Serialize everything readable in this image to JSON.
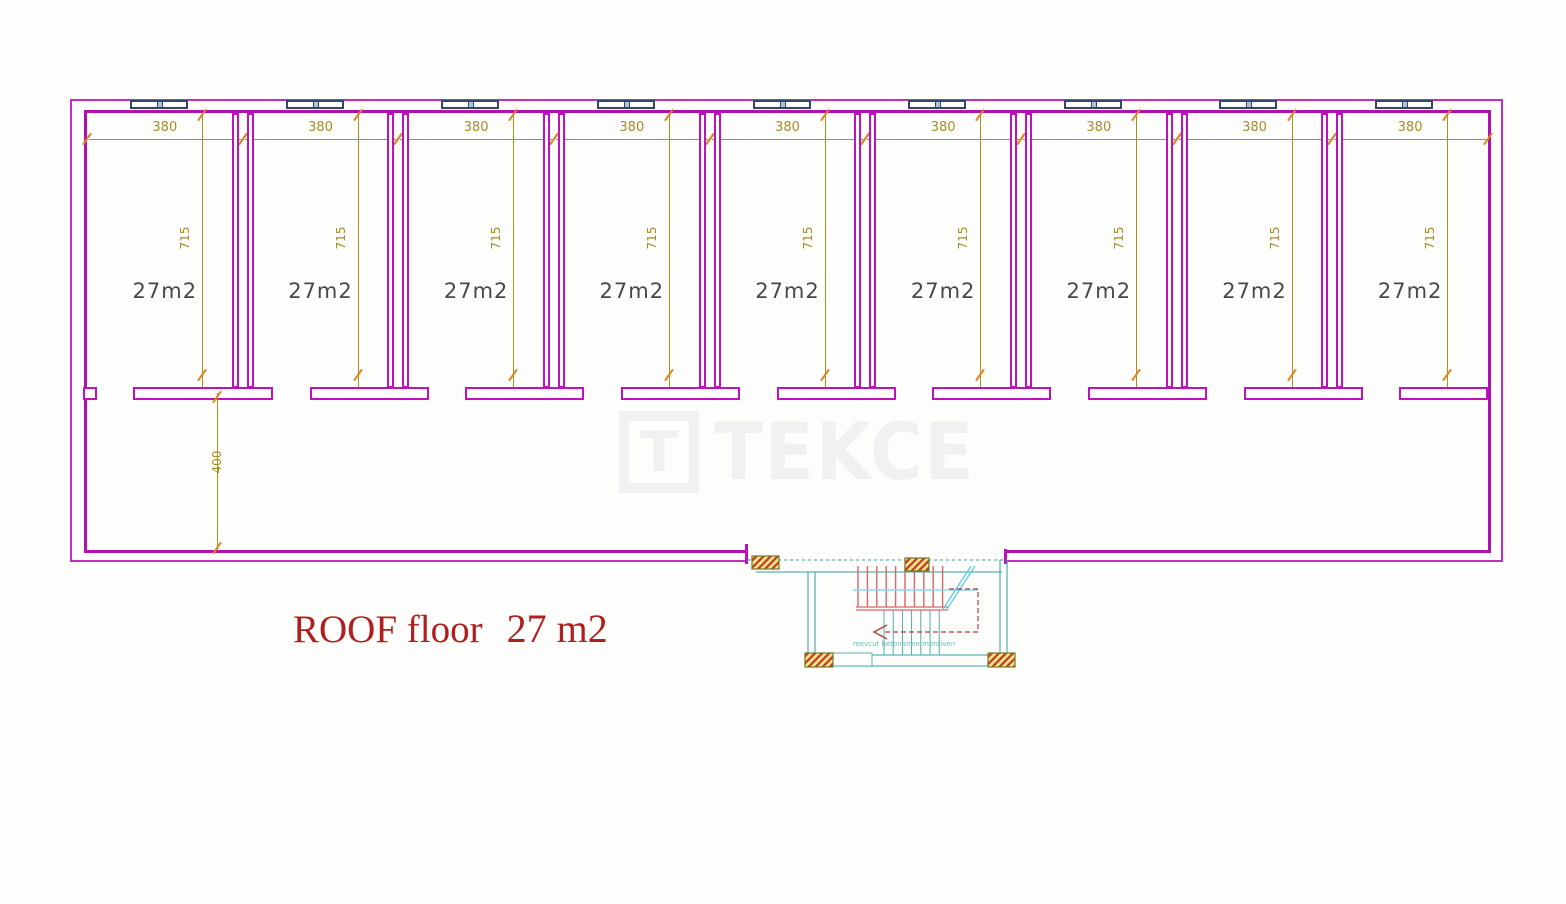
{
  "floor": {
    "title": "ROOF floor",
    "area": "27 m2"
  },
  "rooms": [
    {
      "area": "27m2",
      "width": "380",
      "depth": "715"
    },
    {
      "area": "27m2",
      "width": "380",
      "depth": "715"
    },
    {
      "area": "27m2",
      "width": "380",
      "depth": "715"
    },
    {
      "area": "27m2",
      "width": "380",
      "depth": "715"
    },
    {
      "area": "27m2",
      "width": "380",
      "depth": "715"
    },
    {
      "area": "27m2",
      "width": "380",
      "depth": "715"
    },
    {
      "area": "27m2",
      "width": "380",
      "depth": "715"
    },
    {
      "area": "27m2",
      "width": "380",
      "depth": "715"
    },
    {
      "area": "27m2",
      "width": "380",
      "depth": "715"
    }
  ],
  "corridor": {
    "depth": "400"
  },
  "stair": {
    "note": "mevcut betonarme merdiven"
  },
  "watermark": {
    "logo_letter": "T",
    "brand": "TEKCE"
  },
  "colors": {
    "wall": "#BF12BF",
    "dimension": "#B09018",
    "tick": "#DC851F",
    "room_label": "#484848",
    "title": "#AF1F1F",
    "stair": "#35A0A0",
    "stair_tread": "#D46868",
    "window_frame": "#36466B",
    "watermark": "#F1F1F1"
  }
}
